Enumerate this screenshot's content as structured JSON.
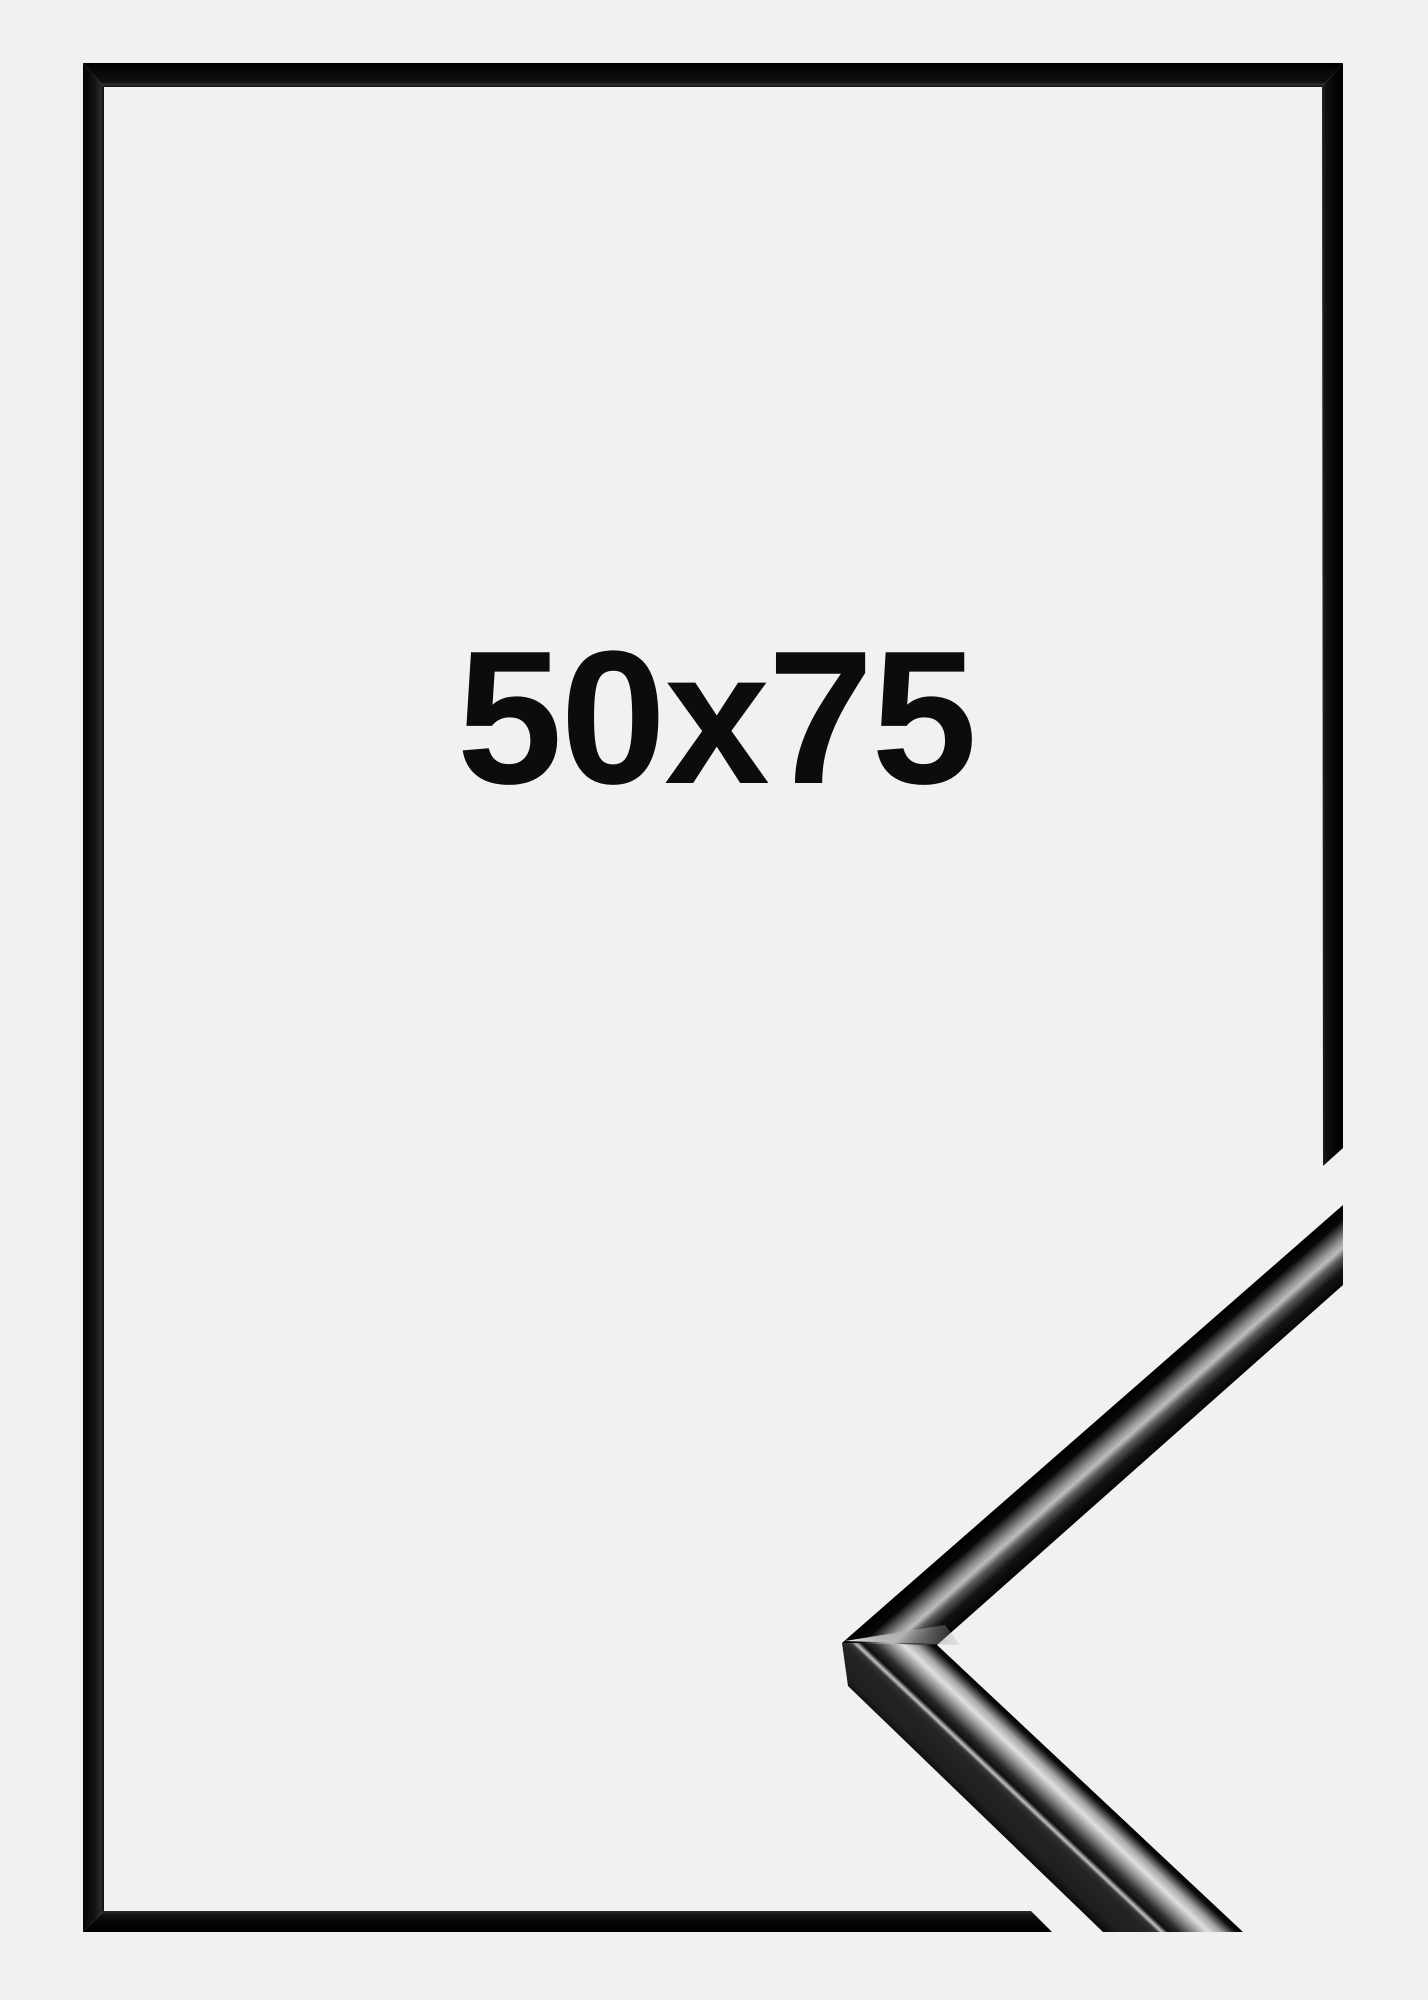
{
  "scene": {
    "background_color": "#f1f1f2",
    "size_label": "50x75",
    "label_color": "#0c0c0c",
    "frame_color": "#0b0b0b",
    "gloss_highlight_color": "#e2e2e2"
  }
}
